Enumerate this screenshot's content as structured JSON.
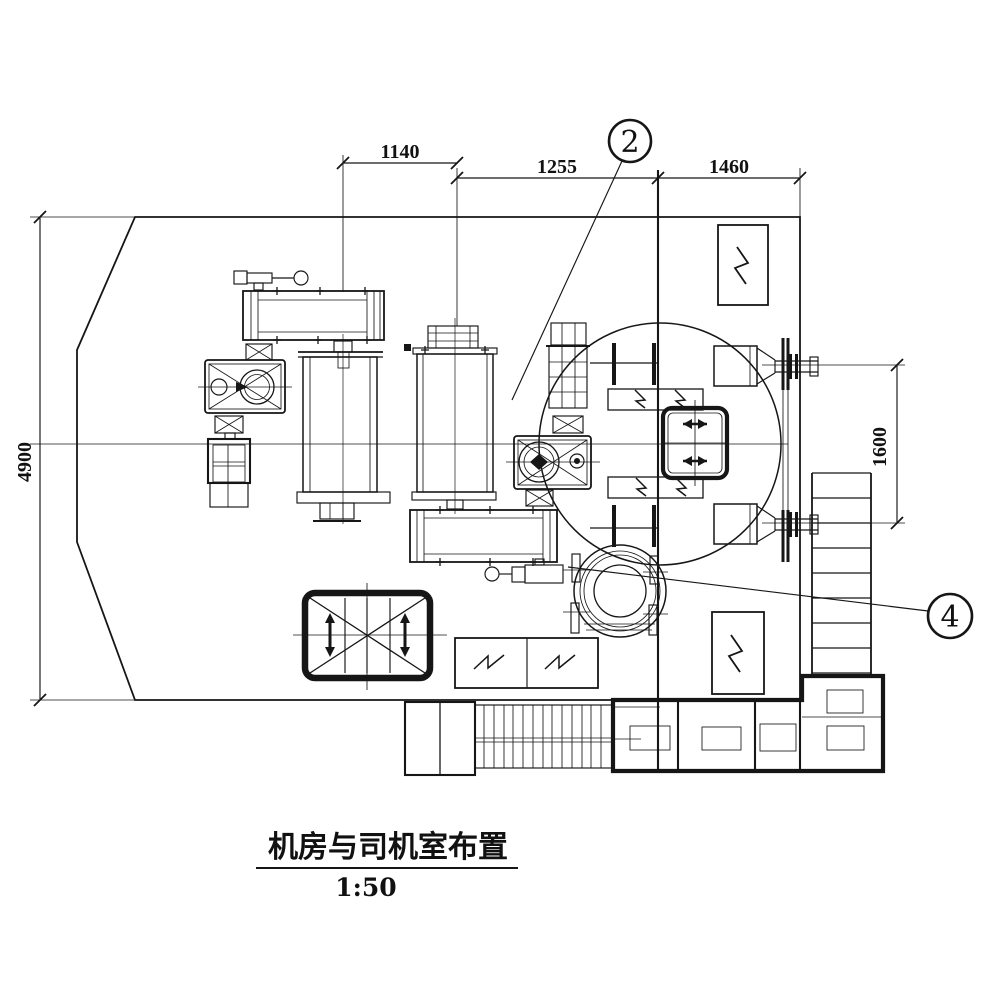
{
  "drawing": {
    "title": {
      "text": "机房与司机室布置",
      "scale": "1:50"
    },
    "dimensions": {
      "top_left": "1140",
      "top_middle": "1255",
      "top_right": "1460",
      "left": "4900",
      "right": "1600"
    },
    "callouts": {
      "c2": "2",
      "c4": "4"
    },
    "palette": {
      "ink": "#161616",
      "paper": "#ffffff"
    },
    "components": [
      "machine-room-outline",
      "hoist-motor-1",
      "brake-release-lever-1",
      "hoist-gearbox-1",
      "brake-unit-1",
      "rope-drum-1",
      "rope-drum-2",
      "hoist-gearbox-2",
      "brake-unit-2",
      "hoist-motor-2",
      "brake-release-lever-2",
      "slewing-ring",
      "slew-drive-unit",
      "operator-seat",
      "resistor-frames",
      "resistor-box-center",
      "resistor-box-top-right",
      "resistor-box-right",
      "floor-hatch",
      "counterweight-bay",
      "walkway-grating",
      "access-ladder",
      "cable-reel-top",
      "cable-reel-bottom"
    ]
  }
}
